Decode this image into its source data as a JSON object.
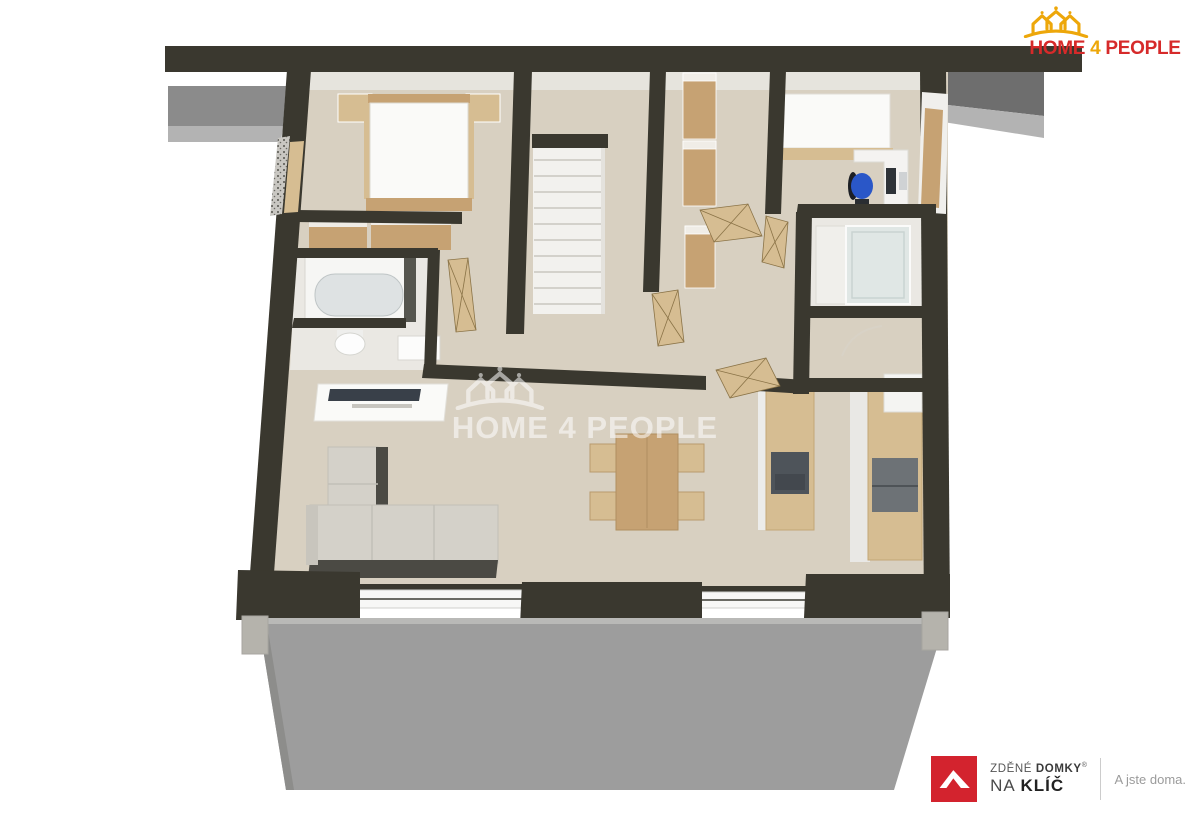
{
  "branding": {
    "header_logo": {
      "home": "HOME",
      "four": "4",
      "people": "PEOPLE"
    },
    "watermark": {
      "text": "HOME 4 PEOPLE"
    },
    "footer_logo": {
      "brand_word1": "ZDĚNÉ",
      "brand_word2": "DOMKY",
      "registered": "®",
      "line2_word1": "NA",
      "line2_word2": "KLÍČ",
      "tagline": "A jste doma."
    }
  },
  "colors": {
    "wall": "#3a382f",
    "floor": "#d8d0c1",
    "floor_light": "#eae8e3",
    "stairs": "#f2f1ee",
    "wood": "#c6a273",
    "wood_light": "#d6bd92",
    "white_furn": "#fafaf8",
    "sofa": "#d4d1c9",
    "sofa_dark": "#4b4a44",
    "terrace": "#9d9d9d",
    "roof": "#8b8b8b",
    "roof_dark": "#6e6e6e",
    "roof_light": "#b3b3b3",
    "glass": "#dfe7e6",
    "appliance": "#6d7276",
    "chair_blue": "#2a57c8",
    "concrete": "#b5b3ac",
    "brand_red": "#d62a2a",
    "brand_gold": "#eda70a",
    "logo_red": "#d3232e",
    "text_dark": "#3a3a3a",
    "text_mid": "#555555",
    "text_gray": "#9b9b9b",
    "watermark_white": "#ffffff"
  }
}
